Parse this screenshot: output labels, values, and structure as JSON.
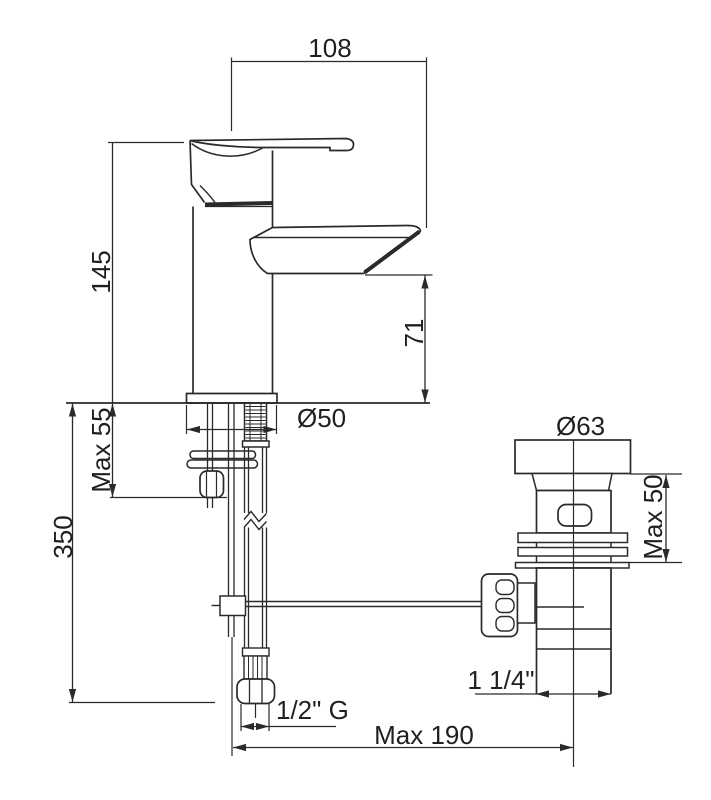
{
  "diagram": {
    "type": "technical-drawing",
    "subject": "Single-lever basin mixer tap with pop-up waste, side elevation with dimensions",
    "units": "mm",
    "colors": {
      "background": "#ffffff",
      "line": "#2a2a2a",
      "text": "#1f1f1f"
    },
    "labels": {
      "spout_projection": "108",
      "body_height": "145",
      "spout_outlet_height": "71",
      "max_deck_thickness_mixer": "Max 55",
      "supply_hose_length": "350",
      "base_diameter": "Ø50",
      "waste_flange_diameter": "Ø63",
      "max_deck_thickness_waste": "Max 50",
      "waste_outlet_thread": "1 1/4\"",
      "supply_connection_thread": "1/2\" G",
      "max_rod_reach": "Max 190"
    }
  }
}
